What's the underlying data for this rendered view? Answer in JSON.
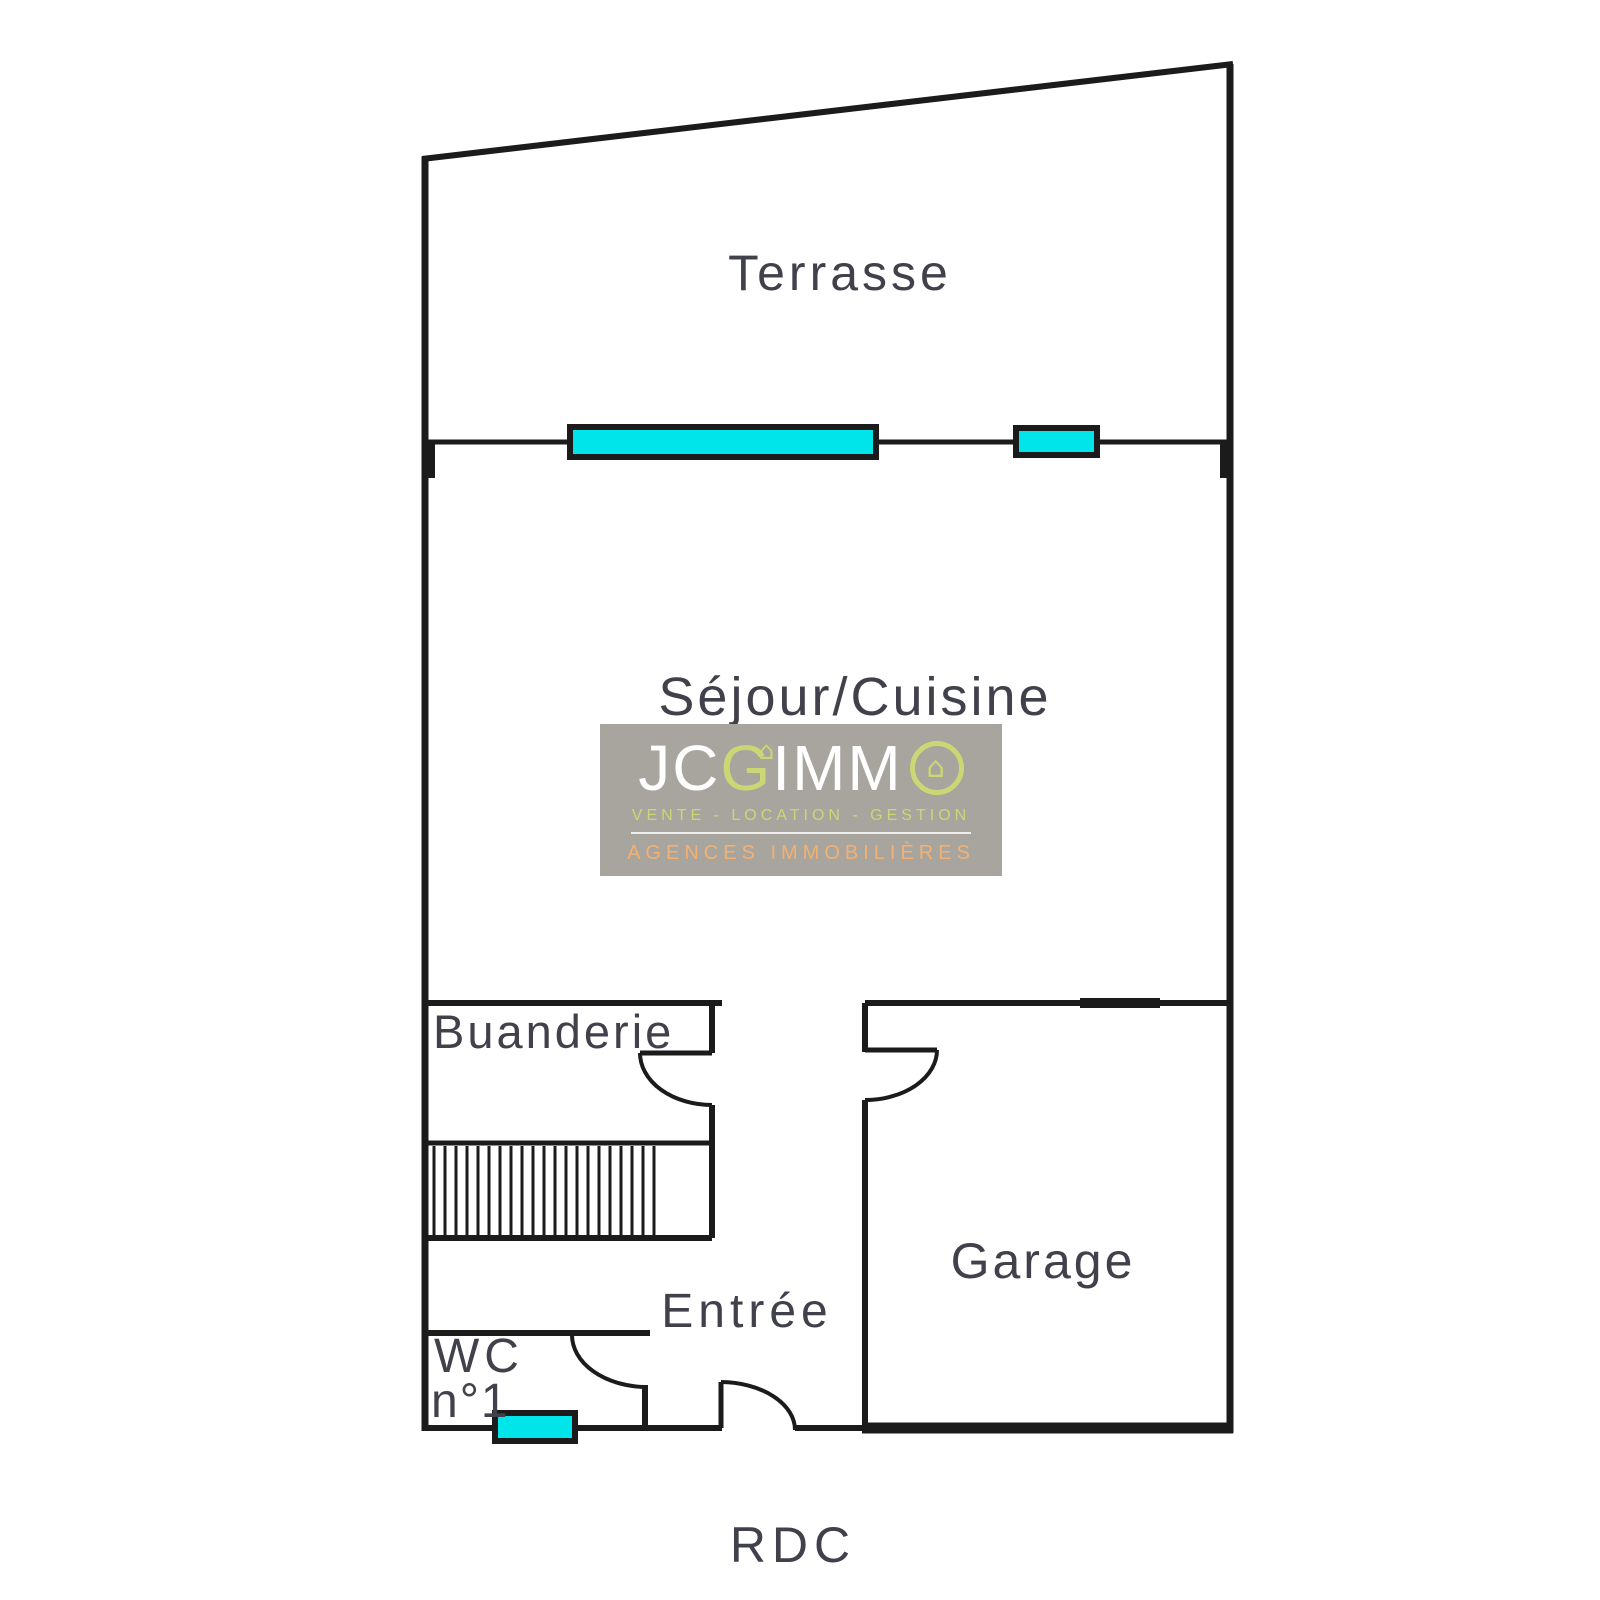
{
  "plan": {
    "floor_label": "RDC",
    "rooms": {
      "terrasse": "Terrasse",
      "sejour_cuisine": "Séjour/Cuisine",
      "buanderie": "Buanderie",
      "garage": "Garage",
      "entree": "Entrée",
      "wc_line1": "WC",
      "wc_line2": "n°1"
    },
    "colors": {
      "wall": "#1b1b1b",
      "window_fill": "#00e5ea",
      "room_label": "#41414c"
    }
  },
  "watermark": {
    "brand": {
      "jc": "JC",
      "g": "G",
      "imm": "IMM"
    },
    "icons": {
      "house": "⌂"
    },
    "tagline": "VENTE - LOCATION - GESTION",
    "subtitle": "AGENCES IMMOBILIÈRES",
    "colors": {
      "background": "#a8a49e",
      "brand_text": "#ffffff",
      "accent_green": "#cbd774",
      "accent_orange": "#f2b173"
    }
  }
}
